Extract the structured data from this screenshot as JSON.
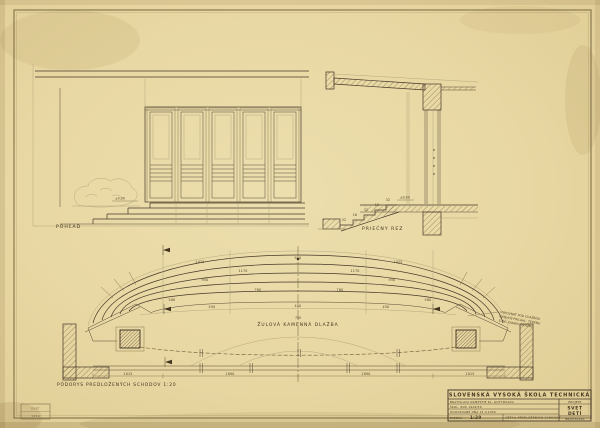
{
  "sheet": {
    "colors": {
      "paper": "#e8d8a6",
      "ink": "#46382a",
      "faint_ink": "#8c7b54",
      "pencil": "#b0a37c"
    }
  },
  "elevation": {
    "label": "POHĽAD",
    "level": "±0,00"
  },
  "section": {
    "label": "PRIEČNY REZ",
    "level": "±0,00",
    "dims": [
      {
        "x": 388,
        "y": 201,
        "t": "32"
      },
      {
        "x": 377,
        "y": 206,
        "t": "16"
      },
      {
        "x": 366,
        "y": 211,
        "t": "32"
      },
      {
        "x": 355,
        "y": 216,
        "t": "16"
      },
      {
        "x": 344,
        "y": 221,
        "t": "32"
      }
    ]
  },
  "plan": {
    "label": "PÔDORYS PREDLOŽENÝCH SCHODOV 1:20",
    "paving_label": "ŽULOVÁ KAMENNÁ DLAŽBA",
    "paving_level": "750",
    "note_lines": [
      "VYROVNAŤ POD DLAŽBOU",
      "ÚROVEŇ PRIĽAHL. TERÉNU",
      "S OK. KAMEN. DLAŽBY"
    ],
    "dims": [
      {
        "x": 200,
        "y": 263,
        "t": "1425"
      },
      {
        "x": 298,
        "y": 259,
        "t": "950"
      },
      {
        "x": 398,
        "y": 263,
        "t": "1425"
      },
      {
        "x": 243,
        "y": 272,
        "t": "1170"
      },
      {
        "x": 355,
        "y": 272,
        "t": "1170"
      },
      {
        "x": 205,
        "y": 281,
        "t": "950"
      },
      {
        "x": 392,
        "y": 281,
        "t": "950"
      },
      {
        "x": 258,
        "y": 291,
        "t": "760"
      },
      {
        "x": 340,
        "y": 291,
        "t": "760"
      },
      {
        "x": 172,
        "y": 301,
        "t": "580"
      },
      {
        "x": 428,
        "y": 301,
        "t": "580"
      },
      {
        "x": 212,
        "y": 308,
        "t": "450"
      },
      {
        "x": 298,
        "y": 307,
        "t": "450"
      },
      {
        "x": 386,
        "y": 308,
        "t": "450"
      },
      {
        "x": 128,
        "y": 375,
        "t": "1015"
      },
      {
        "x": 230,
        "y": 375,
        "t": "1890"
      },
      {
        "x": 366,
        "y": 375,
        "t": "1890"
      },
      {
        "x": 470,
        "y": 375,
        "t": "1015"
      }
    ]
  },
  "title_block": {
    "school": "SLOVENSKÁ VYSOKÁ ŠKOLA TECHNICKÁ",
    "row1": "BRATISLAVA NÁMESTIE KL. GOTTWALDA",
    "row2": "ŠKOL. ROK 1949/50",
    "row3": "ODOVZDANÉ DŇA 15.V.1950",
    "scale_label": "MIERKA",
    "scale_value": "1:20",
    "drawing_title": "DETAIL PREDLOŽENÝCH SCHODOV",
    "project_header": "PROJEKT",
    "project_line1": "SVET",
    "project_line2": "DETÍ",
    "city": "BRATISLAVA"
  },
  "stamp": {
    "line1": "SVŠT",
    "line2": "1950"
  }
}
